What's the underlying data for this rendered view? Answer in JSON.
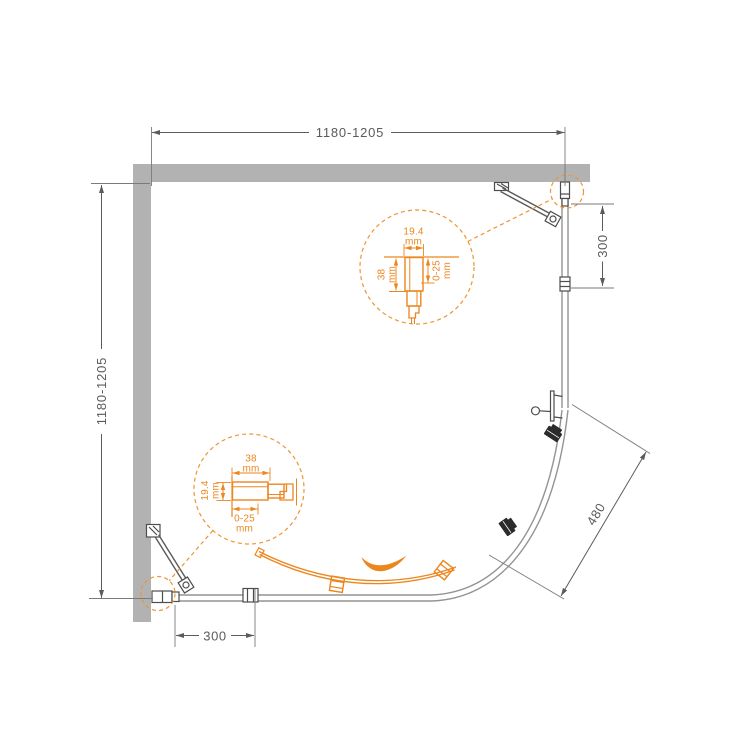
{
  "colors": {
    "accent_orange": "#ec861e",
    "dashed_orange": "#ef9433",
    "wall_gray": "#b2b2b2",
    "line_gray": "#5b5b5b",
    "glass_gray": "#949494",
    "roller_dark": "#2b2b2b"
  },
  "dimensions": {
    "top_width": "1180-1205",
    "left_depth": "1180-1205",
    "right_fixed_section": "300",
    "bottom_fixed_section": "300",
    "door_opening_diagonal": "480"
  },
  "callout_top": {
    "profile_width": "19.4",
    "profile_width_unit": "mm",
    "profile_depth": "38",
    "profile_depth_unit": "mm",
    "adjustment_range": "0-25",
    "adjustment_unit": "mm"
  },
  "callout_bottom": {
    "profile_depth": "38",
    "profile_depth_unit": "mm",
    "profile_height": "19.4",
    "profile_height_unit": "mm",
    "adjustment_range": "0-25",
    "adjustment_unit": "mm"
  }
}
